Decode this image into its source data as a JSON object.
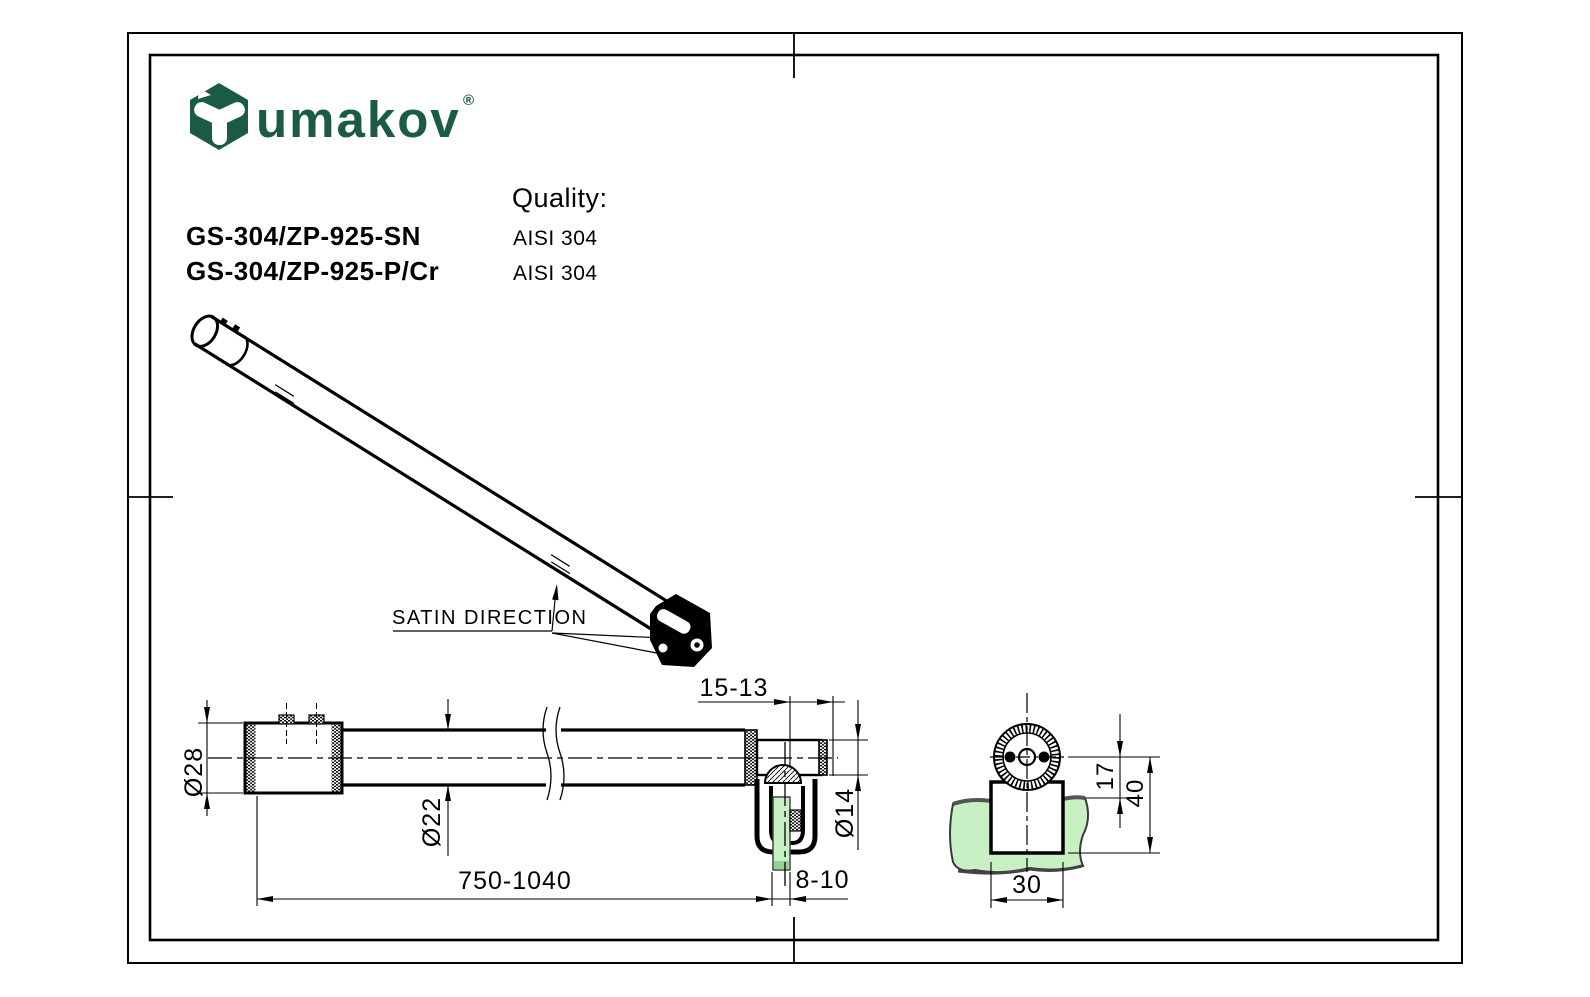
{
  "brand": {
    "name": "umakov",
    "registered": "®",
    "logo_icon": "hexagon-y-mark",
    "color": "#1a5a46"
  },
  "header": {
    "quality_label": "Quality:",
    "products": [
      {
        "code": "GS-304/ZP-925-SN",
        "quality": "AISI 304"
      },
      {
        "code": "GS-304/ZP-925-P/Cr",
        "quality": "AISI 304"
      }
    ]
  },
  "isometric": {
    "label": "SATIN DIRECTION"
  },
  "side_view": {
    "dims": {
      "sleeve_dia": "Ø28",
      "tube_dia": "Ø22",
      "length": "750-1040",
      "end_offset": "15-13",
      "rod_dia": "Ø14",
      "glass_thickness": "8-10"
    }
  },
  "end_view": {
    "dims": {
      "inset": "17",
      "height": "40",
      "width": "30"
    }
  },
  "colors": {
    "glass": "#c9f0c5",
    "glass_edge": "#93d58e",
    "brand_green": "#1a5a46",
    "line": "#000000"
  }
}
